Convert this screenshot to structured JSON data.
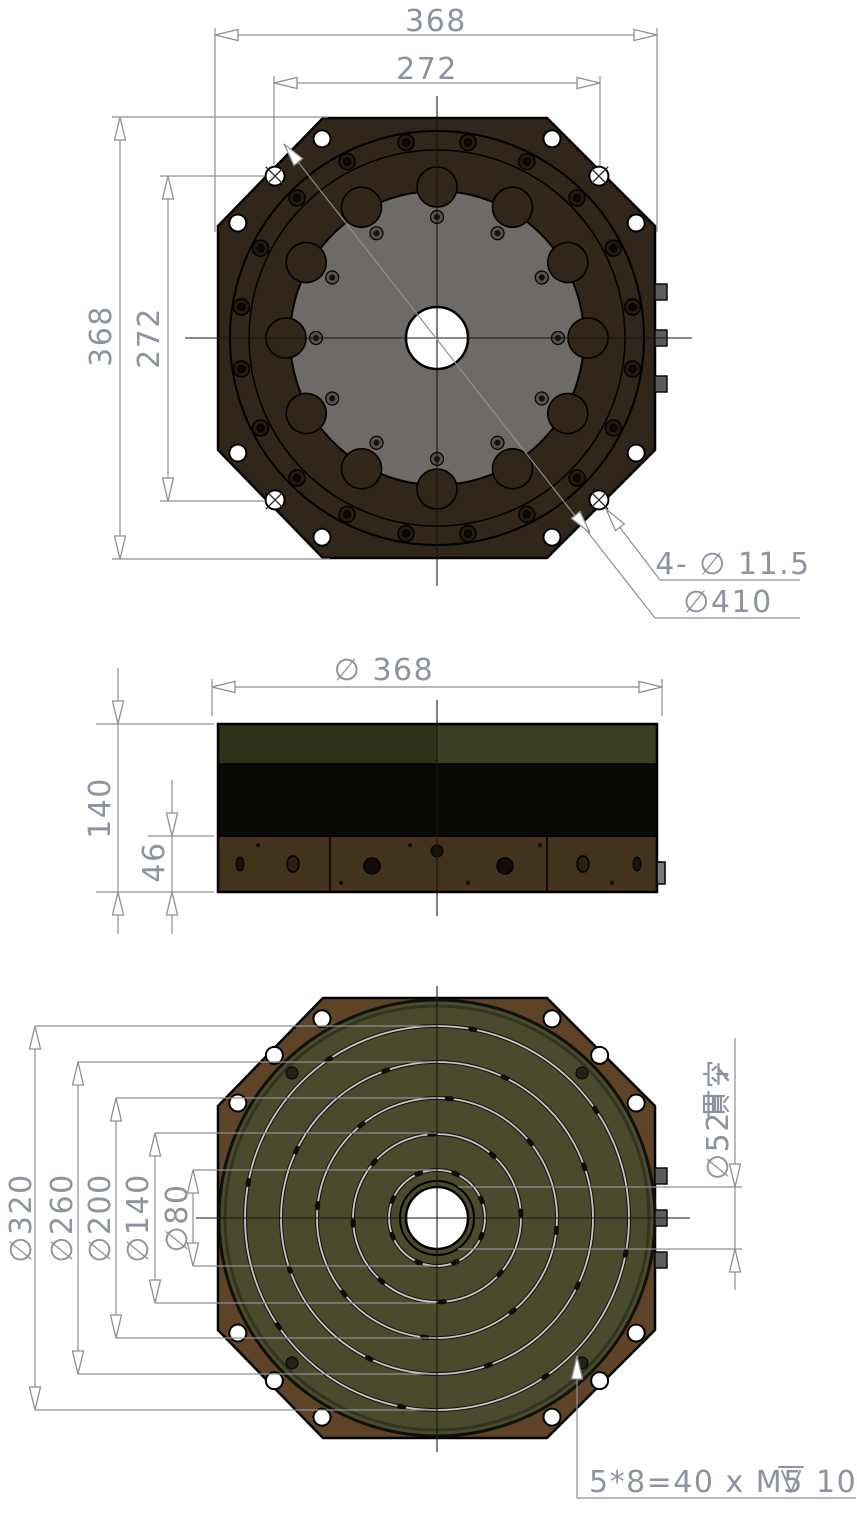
{
  "drawing": {
    "top_view": {
      "dim_width_outer": "368",
      "dim_width_inner": "272",
      "dim_height_outer": "368",
      "dim_height_inner": "272",
      "label_corner_holes": "4- ∅ 11.5",
      "label_bolt_circle": "∅410"
    },
    "side_view": {
      "dim_diameter": "∅ 368",
      "dim_total_height": "140",
      "dim_base_height": "46"
    },
    "bottom_view": {
      "dim_ring_320": "∅320",
      "dim_ring_260": "∅260",
      "dim_ring_200": "∅200",
      "dim_ring_140": "∅140",
      "dim_ring_80": "∅80",
      "dim_center_hole": "∅52",
      "dim_center_hole_suffix": "贯穿",
      "note_thread": "5*8=40 x M5",
      "note_depth": "10"
    },
    "colors": {
      "body_dark_brown": "#30261a",
      "rotor_gray": "#6e6a67",
      "side_green_left": "#2f3219",
      "side_green_right": "#3b3e22",
      "side_black": "#0a0a07",
      "base_brown": "#44331c",
      "bottom_octagon_brown": "#5e4327",
      "bottom_green": "#4a4b2d",
      "dim_text": "#8d93a1",
      "dim_line": "#8f8f94"
    }
  }
}
